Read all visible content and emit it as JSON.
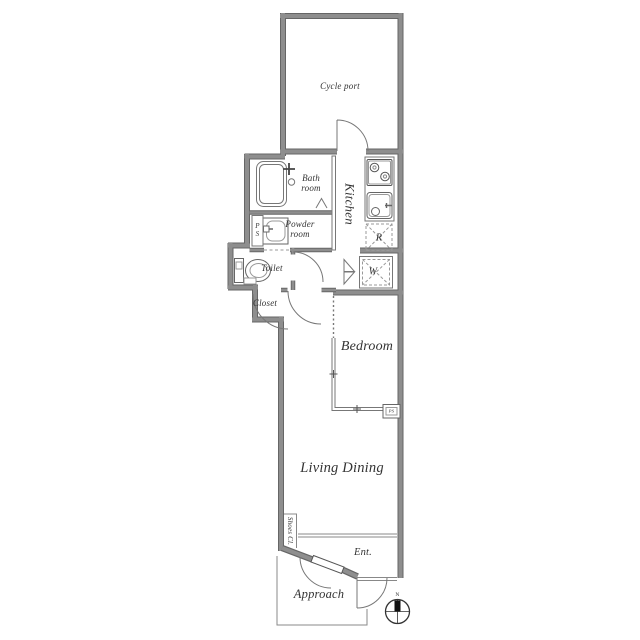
{
  "title": "Apartment floor plan",
  "colors": {
    "background": "#ffffff",
    "wall_fill": "#8e8e8e",
    "wall_edge": "#666666",
    "thin_line": "#777777",
    "text": "#333333",
    "compass_north": "#111111"
  },
  "rooms": {
    "cycle_port": {
      "label": "Cycle port"
    },
    "bath": {
      "label": "Bath\nroom"
    },
    "powder": {
      "label": "Powder\nroom"
    },
    "pipe_space_upper": {
      "label": "P\nS"
    },
    "toilet": {
      "label": "Toilet"
    },
    "kitchen": {
      "label": "Kitchen"
    },
    "refrigerator_space": {
      "label": "R"
    },
    "washer_space": {
      "label": "W"
    },
    "closet": {
      "label": "Closet"
    },
    "bedroom": {
      "label": "Bedroom"
    },
    "living_dining": {
      "label": "Living Dining"
    },
    "shoes_closet": {
      "label": "Shoes Cl."
    },
    "entrance": {
      "label": "Ent."
    },
    "approach": {
      "label": "Approach"
    },
    "pipe_space_lower": {
      "label": "PS"
    }
  },
  "compass": {
    "north_label": "N"
  }
}
